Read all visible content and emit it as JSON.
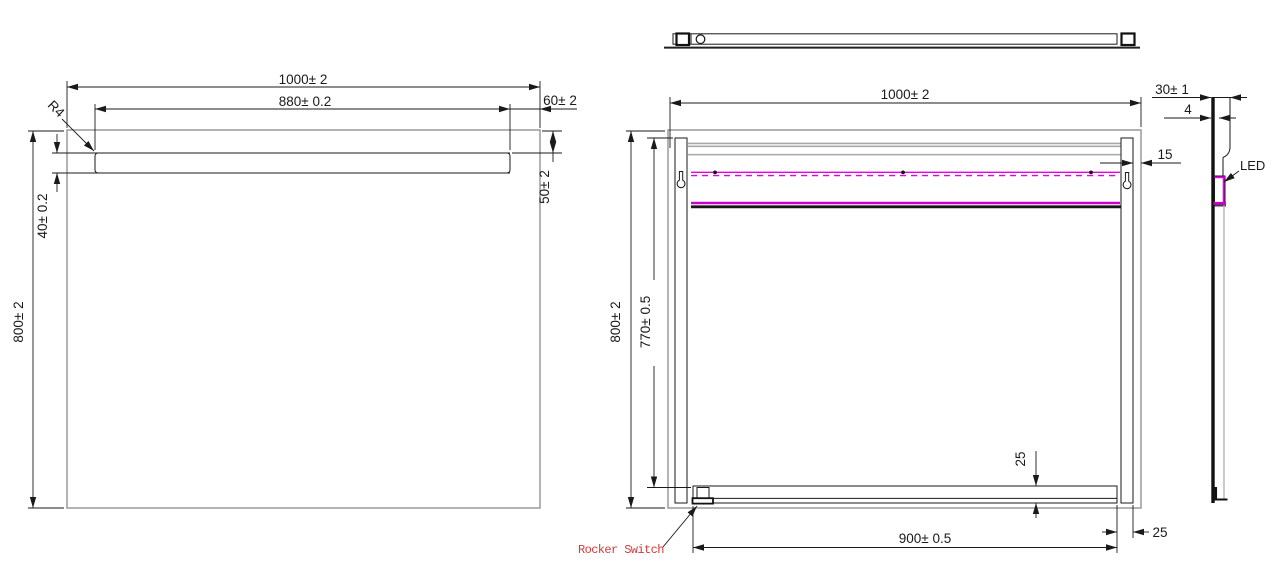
{
  "colors": {
    "line_black": "#1a1a1a",
    "edge_gray": "#9a9a9a",
    "inner_gray": "#a8a8a8",
    "led_magenta": "#e400e4",
    "led_magenta_dark": "#cc00cc",
    "label_red": "#d23a3a"
  },
  "views": {
    "front": {
      "dims": {
        "width": "1000± 2",
        "frost_width": "880± 0.2",
        "right_gap": "60± 2",
        "strip_top_offset": "50± 2",
        "strip_height": "40± 0.2",
        "height": "800± 2",
        "corner_radius": "R4"
      }
    },
    "back": {
      "dims": {
        "width": "1000± 2",
        "height": "800± 2",
        "bracket_span": "770± 0.5",
        "bracket_edge_gap": "15",
        "bar_height": "25",
        "bar_end_gap": "25",
        "bar_length": "900± 0.5"
      },
      "labels": {
        "rocker_switch": "Rocker Switch"
      }
    },
    "side": {
      "dims": {
        "depth": "30± 1",
        "glass_thickness": "4"
      },
      "labels": {
        "led": "LED"
      }
    }
  }
}
